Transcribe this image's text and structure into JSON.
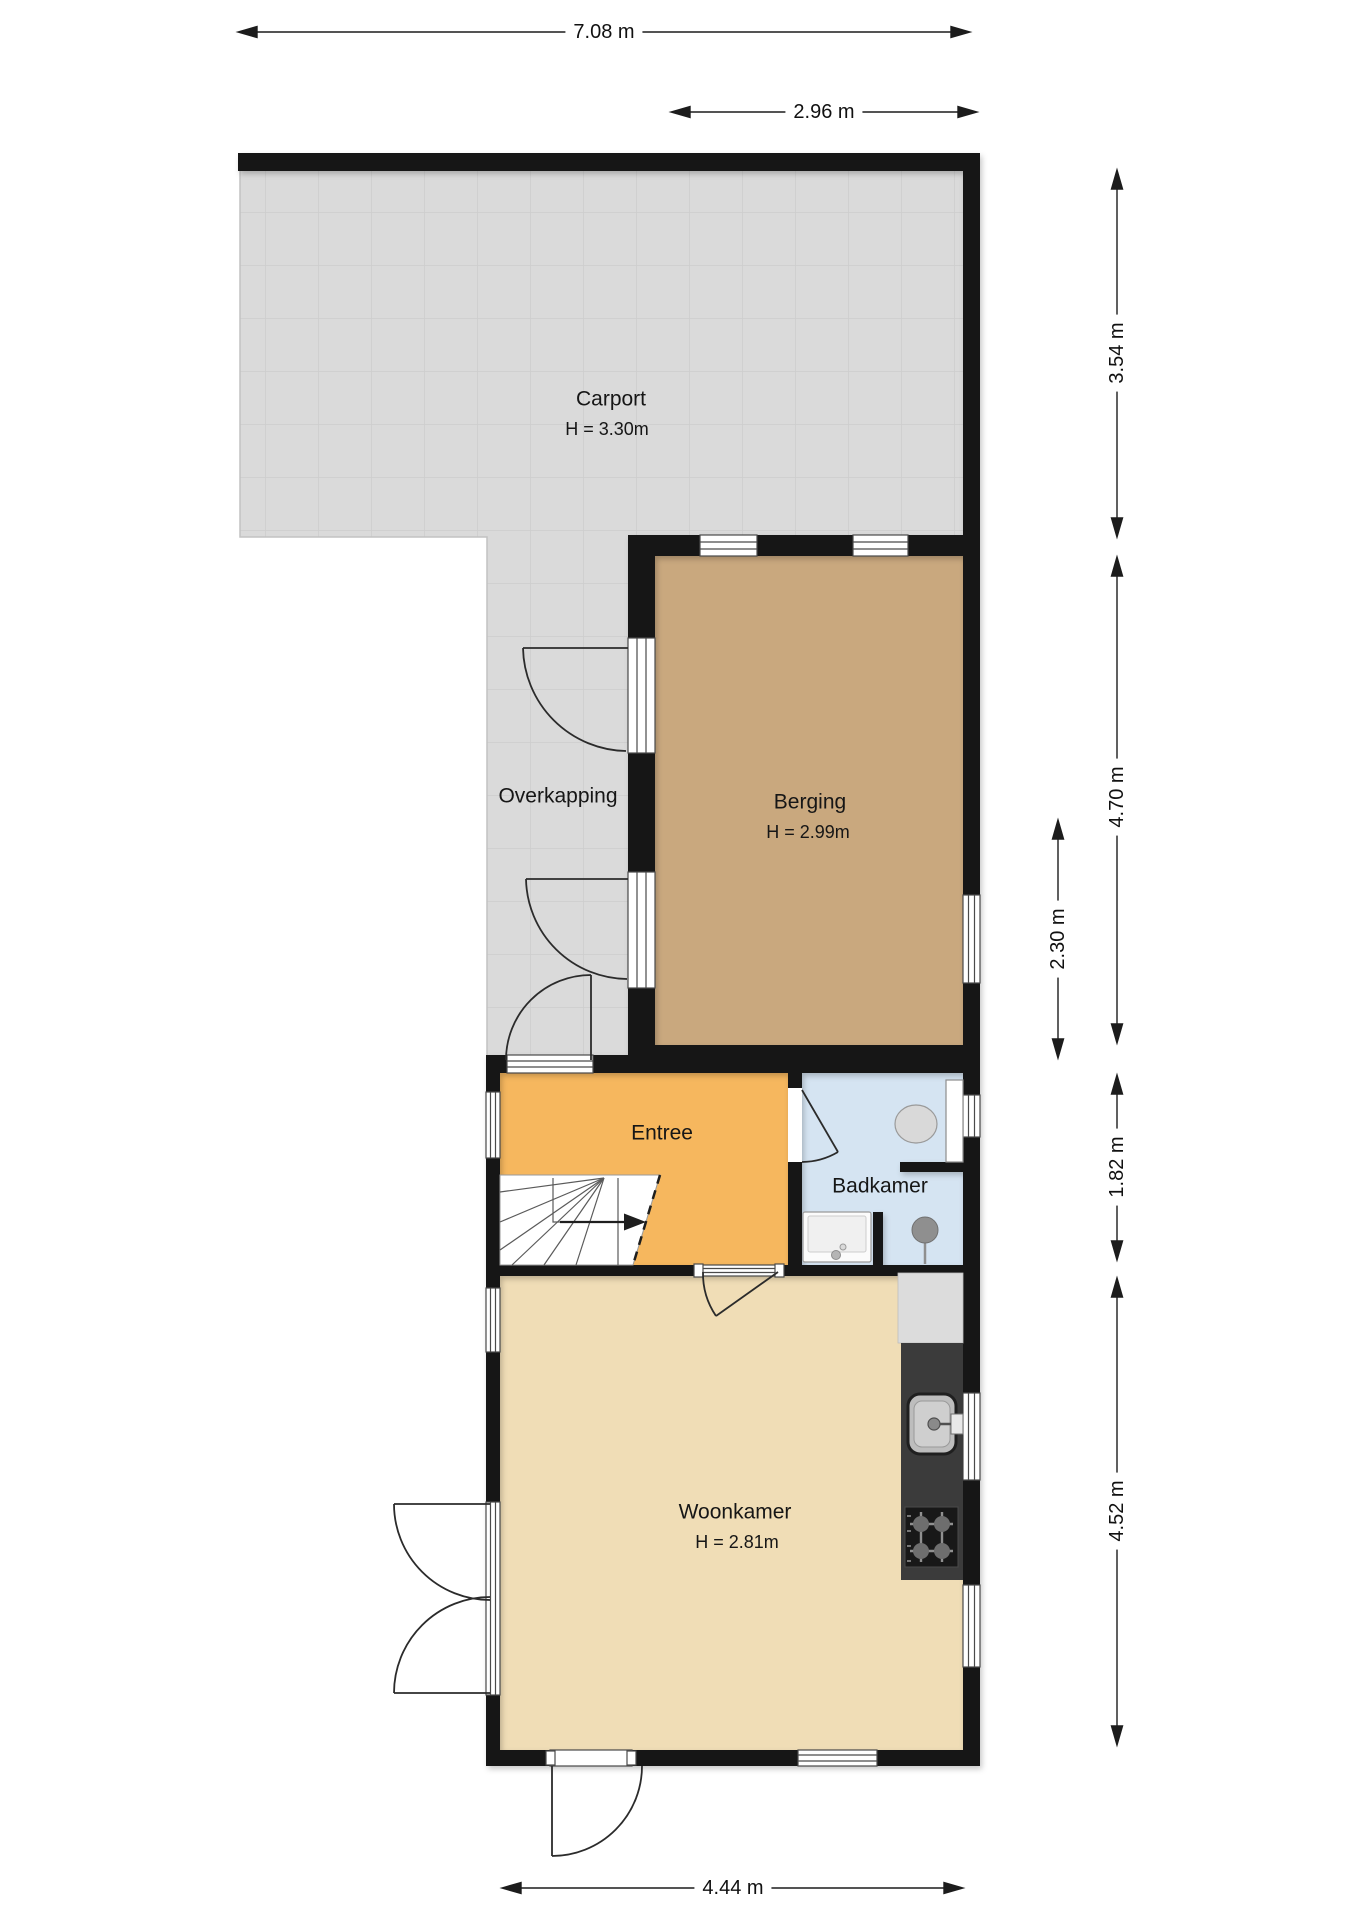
{
  "plan": {
    "title": "floor-plan",
    "rooms": [
      {
        "name": "Carport",
        "height": "H = 3.30m"
      },
      {
        "name": "Overkapping",
        "height": ""
      },
      {
        "name": "Berging",
        "height": "H = 2.99m"
      },
      {
        "name": "Entree",
        "height": ""
      },
      {
        "name": "Badkamer",
        "height": ""
      },
      {
        "name": "Woonkamer",
        "height": "H = 2.81m"
      }
    ],
    "dimensions": {
      "total_width": "7.08 m",
      "berging_width": "2.96 m",
      "carport_depth": "3.54 m",
      "berging_depth": "4.70 m",
      "berging_right_segment": "2.30 m",
      "entree_depth": "1.82 m",
      "woonkamer_depth": "4.52 m",
      "woonkamer_width": "4.44 m"
    },
    "fixtures": [
      "staircase",
      "toilet",
      "washbasin",
      "shower-drain",
      "kitchen-counter",
      "kitchen-sink",
      "gas-hob"
    ],
    "colors": {
      "wall": "#141414",
      "carport_floor": "#dadada",
      "tile_line": "#cdcdcd",
      "berging_floor": "#c9a87e",
      "entree_floor": "#f6b75e",
      "badkamer_floor": "#d5e4f2",
      "woonkamer_floor": "#f0ddb6",
      "counter_dark": "#3b3b3b"
    }
  }
}
